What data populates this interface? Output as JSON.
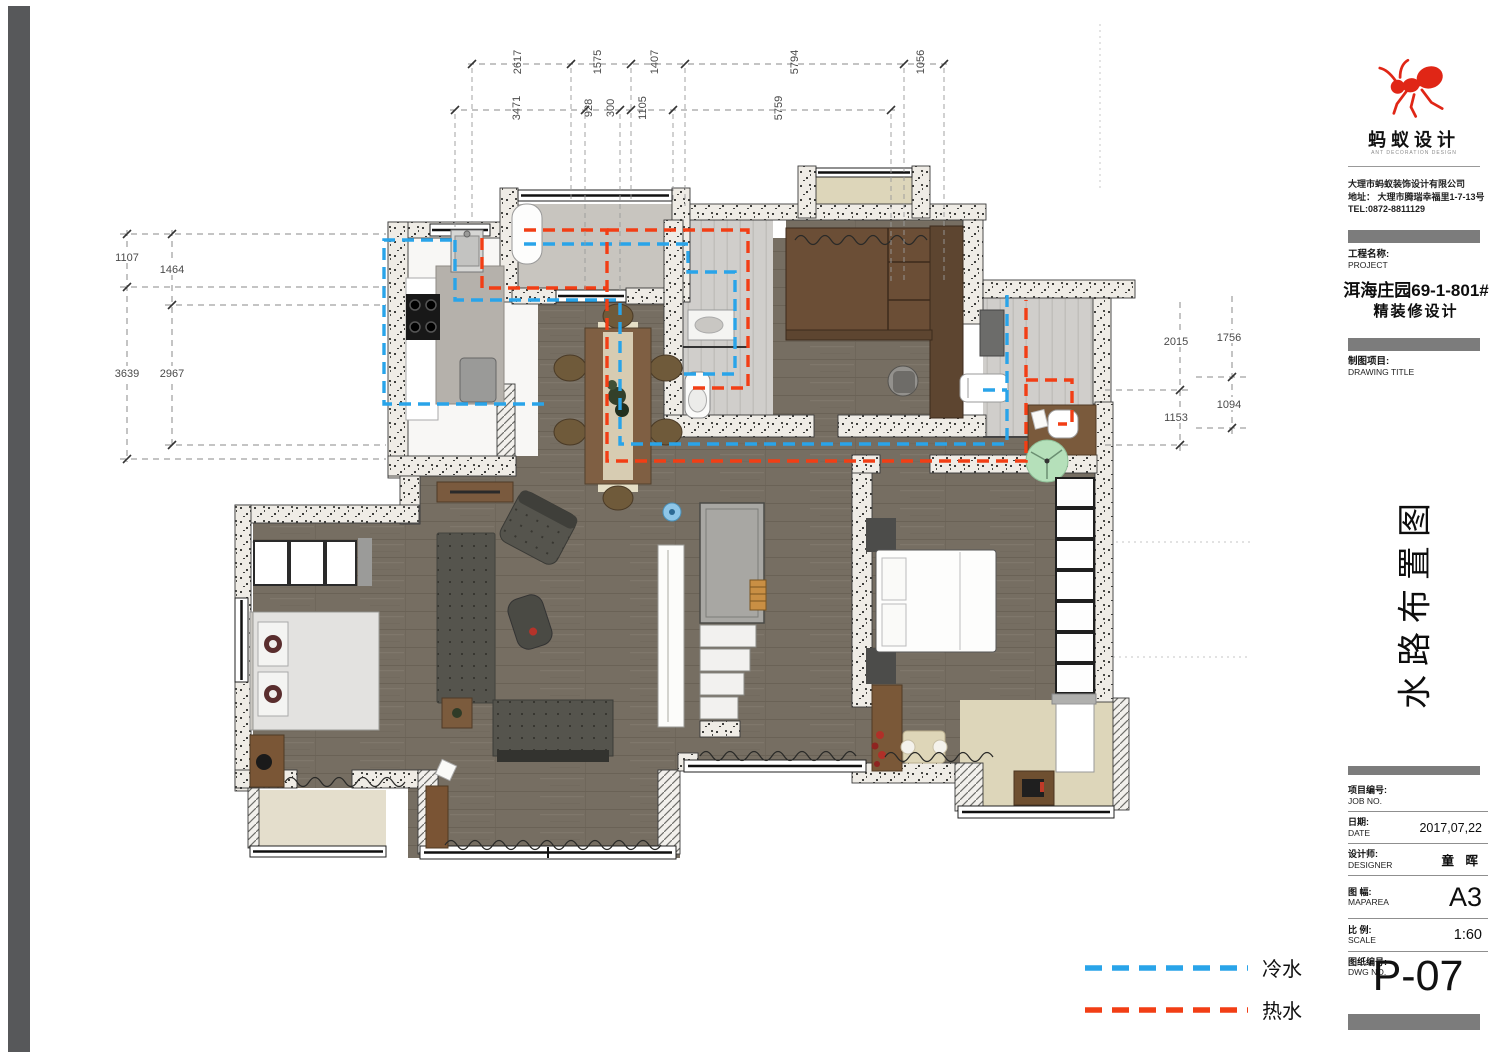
{
  "titleblock": {
    "brand": {
      "name": "蚂蚁设计",
      "subtitle": "ANT DECORATION DESIGN"
    },
    "company": {
      "name": "大理市蚂蚁装饰设计有限公司",
      "address": "地址： 大理市腾瑞幸福里1-7-13号",
      "tel": "TEL:0872-8811129"
    },
    "project": {
      "label_zh": "工程名称:",
      "label_en": "PROJECT",
      "line1": "洱海庄园69-1-801#",
      "line2": "精装修设计"
    },
    "drawing": {
      "label_zh": "制图项目:",
      "label_en": "DRAWING TITLE"
    },
    "drawing_title_vertical": "水路布置图",
    "rows": [
      {
        "zh": "项目编号:",
        "en": "JOB NO.",
        "value": ""
      },
      {
        "zh": "日期:",
        "en": "DATE",
        "value": "2017,07,22"
      },
      {
        "zh": "设计师:",
        "en": "DESIGNER",
        "value": "童 晖"
      },
      {
        "zh": "图 幅:",
        "en": "MAPAREA",
        "value": "A3"
      },
      {
        "zh": "比 例:",
        "en": "SCALE",
        "value": "1:60"
      },
      {
        "zh": "图纸编号:",
        "en": "DWG NO.",
        "value": ""
      }
    ],
    "dwg_no": "P-07"
  },
  "legend": {
    "items": [
      {
        "label": "冷水",
        "color": "#29A4E9"
      },
      {
        "label": "热水",
        "color": "#F23E15"
      }
    ]
  },
  "dimensions": {
    "top_row_outer": [
      "2617",
      "1575",
      "1407",
      "5794",
      "1056"
    ],
    "top_row_inner": [
      "3471",
      "928",
      "300",
      "1105",
      "5759"
    ],
    "left_outer": [
      "1107",
      "3639"
    ],
    "left_inner": [
      "1464",
      "2967"
    ],
    "right_inner": [
      "2015",
      "1153"
    ],
    "right_outer": [
      "1756",
      "1094"
    ]
  },
  "plan": {
    "pipes": {
      "cold_color": "#29A4E9",
      "hot_color": "#F23E15"
    },
    "fixtures": [
      "water-heater",
      "kitchen-sink",
      "stove",
      "fridge",
      "dining-table",
      "bathroom-sink",
      "toilet",
      "washing-machine",
      "laundry-sink",
      "bed",
      "wardrobe",
      "closet",
      "sofa-rug",
      "armchair",
      "tv-console",
      "stairs",
      "robot-vacuum",
      "round-rug",
      "desk-chair"
    ]
  }
}
